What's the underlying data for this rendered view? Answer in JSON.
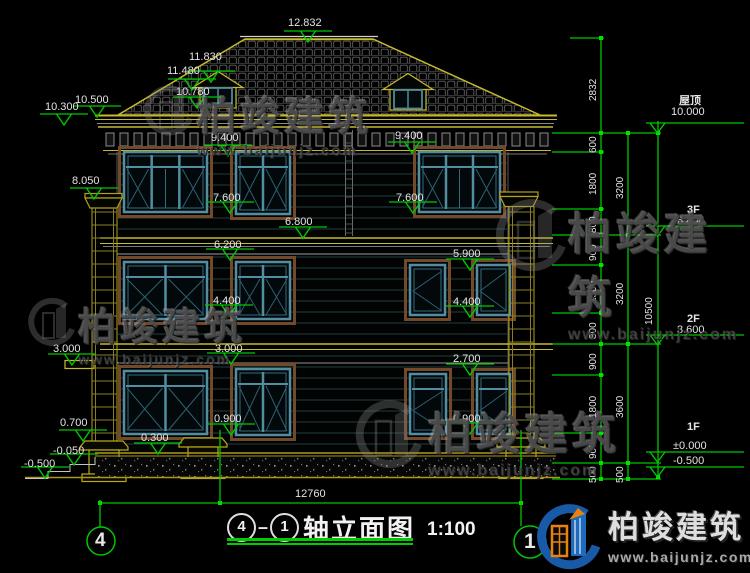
{
  "watermark": {
    "brand": "柏竣建筑",
    "url": "www.baijunjz.com"
  },
  "logo": {
    "brand": "柏竣建筑",
    "url": "www.baijunjz.com"
  },
  "title": {
    "axis_from": "4",
    "axis_to": "1",
    "name": "轴立面图",
    "scale": "1:100"
  },
  "axis_bubbles": {
    "left": "4",
    "right": "1"
  },
  "bottom_dim": "12760",
  "marks": [
    "12.832",
    "11.830",
    "11.480",
    "10.780",
    "10.500",
    "10.300",
    "9.400",
    "9.400",
    "8.050",
    "7.600",
    "7.600",
    "6.800",
    "6.200",
    "5.900",
    "4.400",
    "4.400",
    "3.000",
    "3.000",
    "2.700",
    "0.900",
    "0.900",
    "0.700",
    "0.300",
    "-0.050",
    "-0.500"
  ],
  "levels": [
    {
      "name": "屋顶",
      "value": "10.000"
    },
    {
      "name": "3F",
      "value": "6.800"
    },
    {
      "name": "2F",
      "value": "3.600"
    },
    {
      "name": "1F",
      "value": "±0.000"
    },
    {
      "name": "",
      "value": "-0.500"
    }
  ],
  "chain_inner": [
    "2832",
    "600",
    "1800",
    "800",
    "900",
    "1500",
    "800",
    "900",
    "1800",
    "900",
    "500"
  ],
  "chain_mid": [
    "3200",
    "3200",
    "3600",
    "500"
  ],
  "chain_outer": [
    "10500"
  ],
  "colors": {
    "dim_green": "#00c800",
    "cad_yellow": "#c6ba2e",
    "window_teal": "#538da0",
    "trim_brown": "#74492a",
    "logo_blue": "#1859a8",
    "logo_orange": "#e8820c"
  }
}
